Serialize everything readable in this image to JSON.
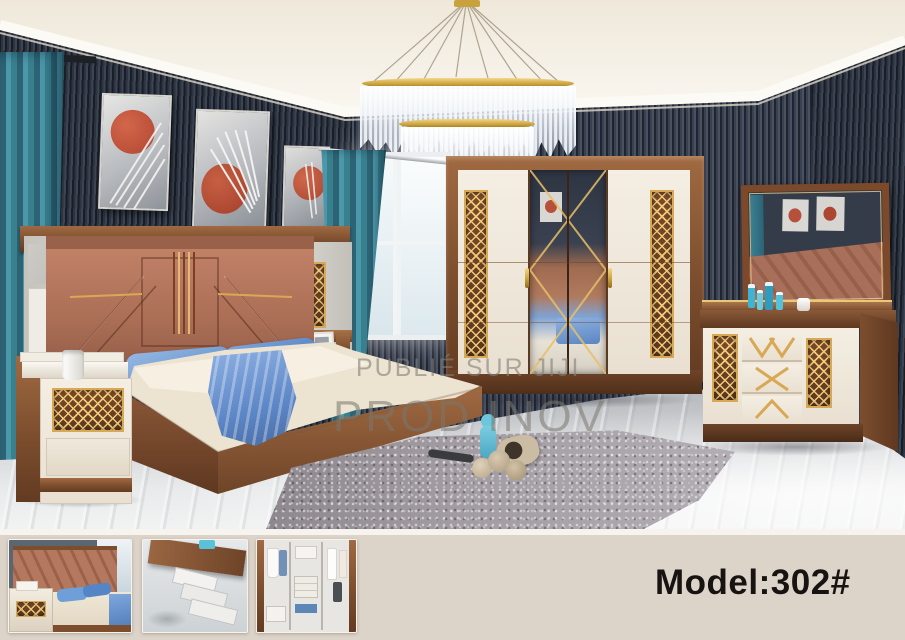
{
  "photo": {
    "watermark": {
      "line1": "PUBLIÉ SUR JIJI",
      "line2": "PROD INOV"
    }
  },
  "footer": {
    "model_label": "Model:302#",
    "thumbnails": [
      {
        "name": "bed-closeup"
      },
      {
        "name": "dresser-open-drawers"
      },
      {
        "name": "wardrobe-interior"
      }
    ]
  },
  "palette": {
    "wall_slats": "#3a4150",
    "ceiling": "#f2ecdf",
    "wood": "#8a5a38",
    "cream_furniture": "#efe7da",
    "gold_accent": "#d9a855",
    "copper_headboard": "#b4785e",
    "teal_curtain": "#3f8496",
    "blue_bedding": "#6f9fd8",
    "floor_marble": "#d6d8da",
    "rug_gray": "#a39da3",
    "footer_background": "#dcd3c9",
    "model_text_color": "#161310"
  }
}
